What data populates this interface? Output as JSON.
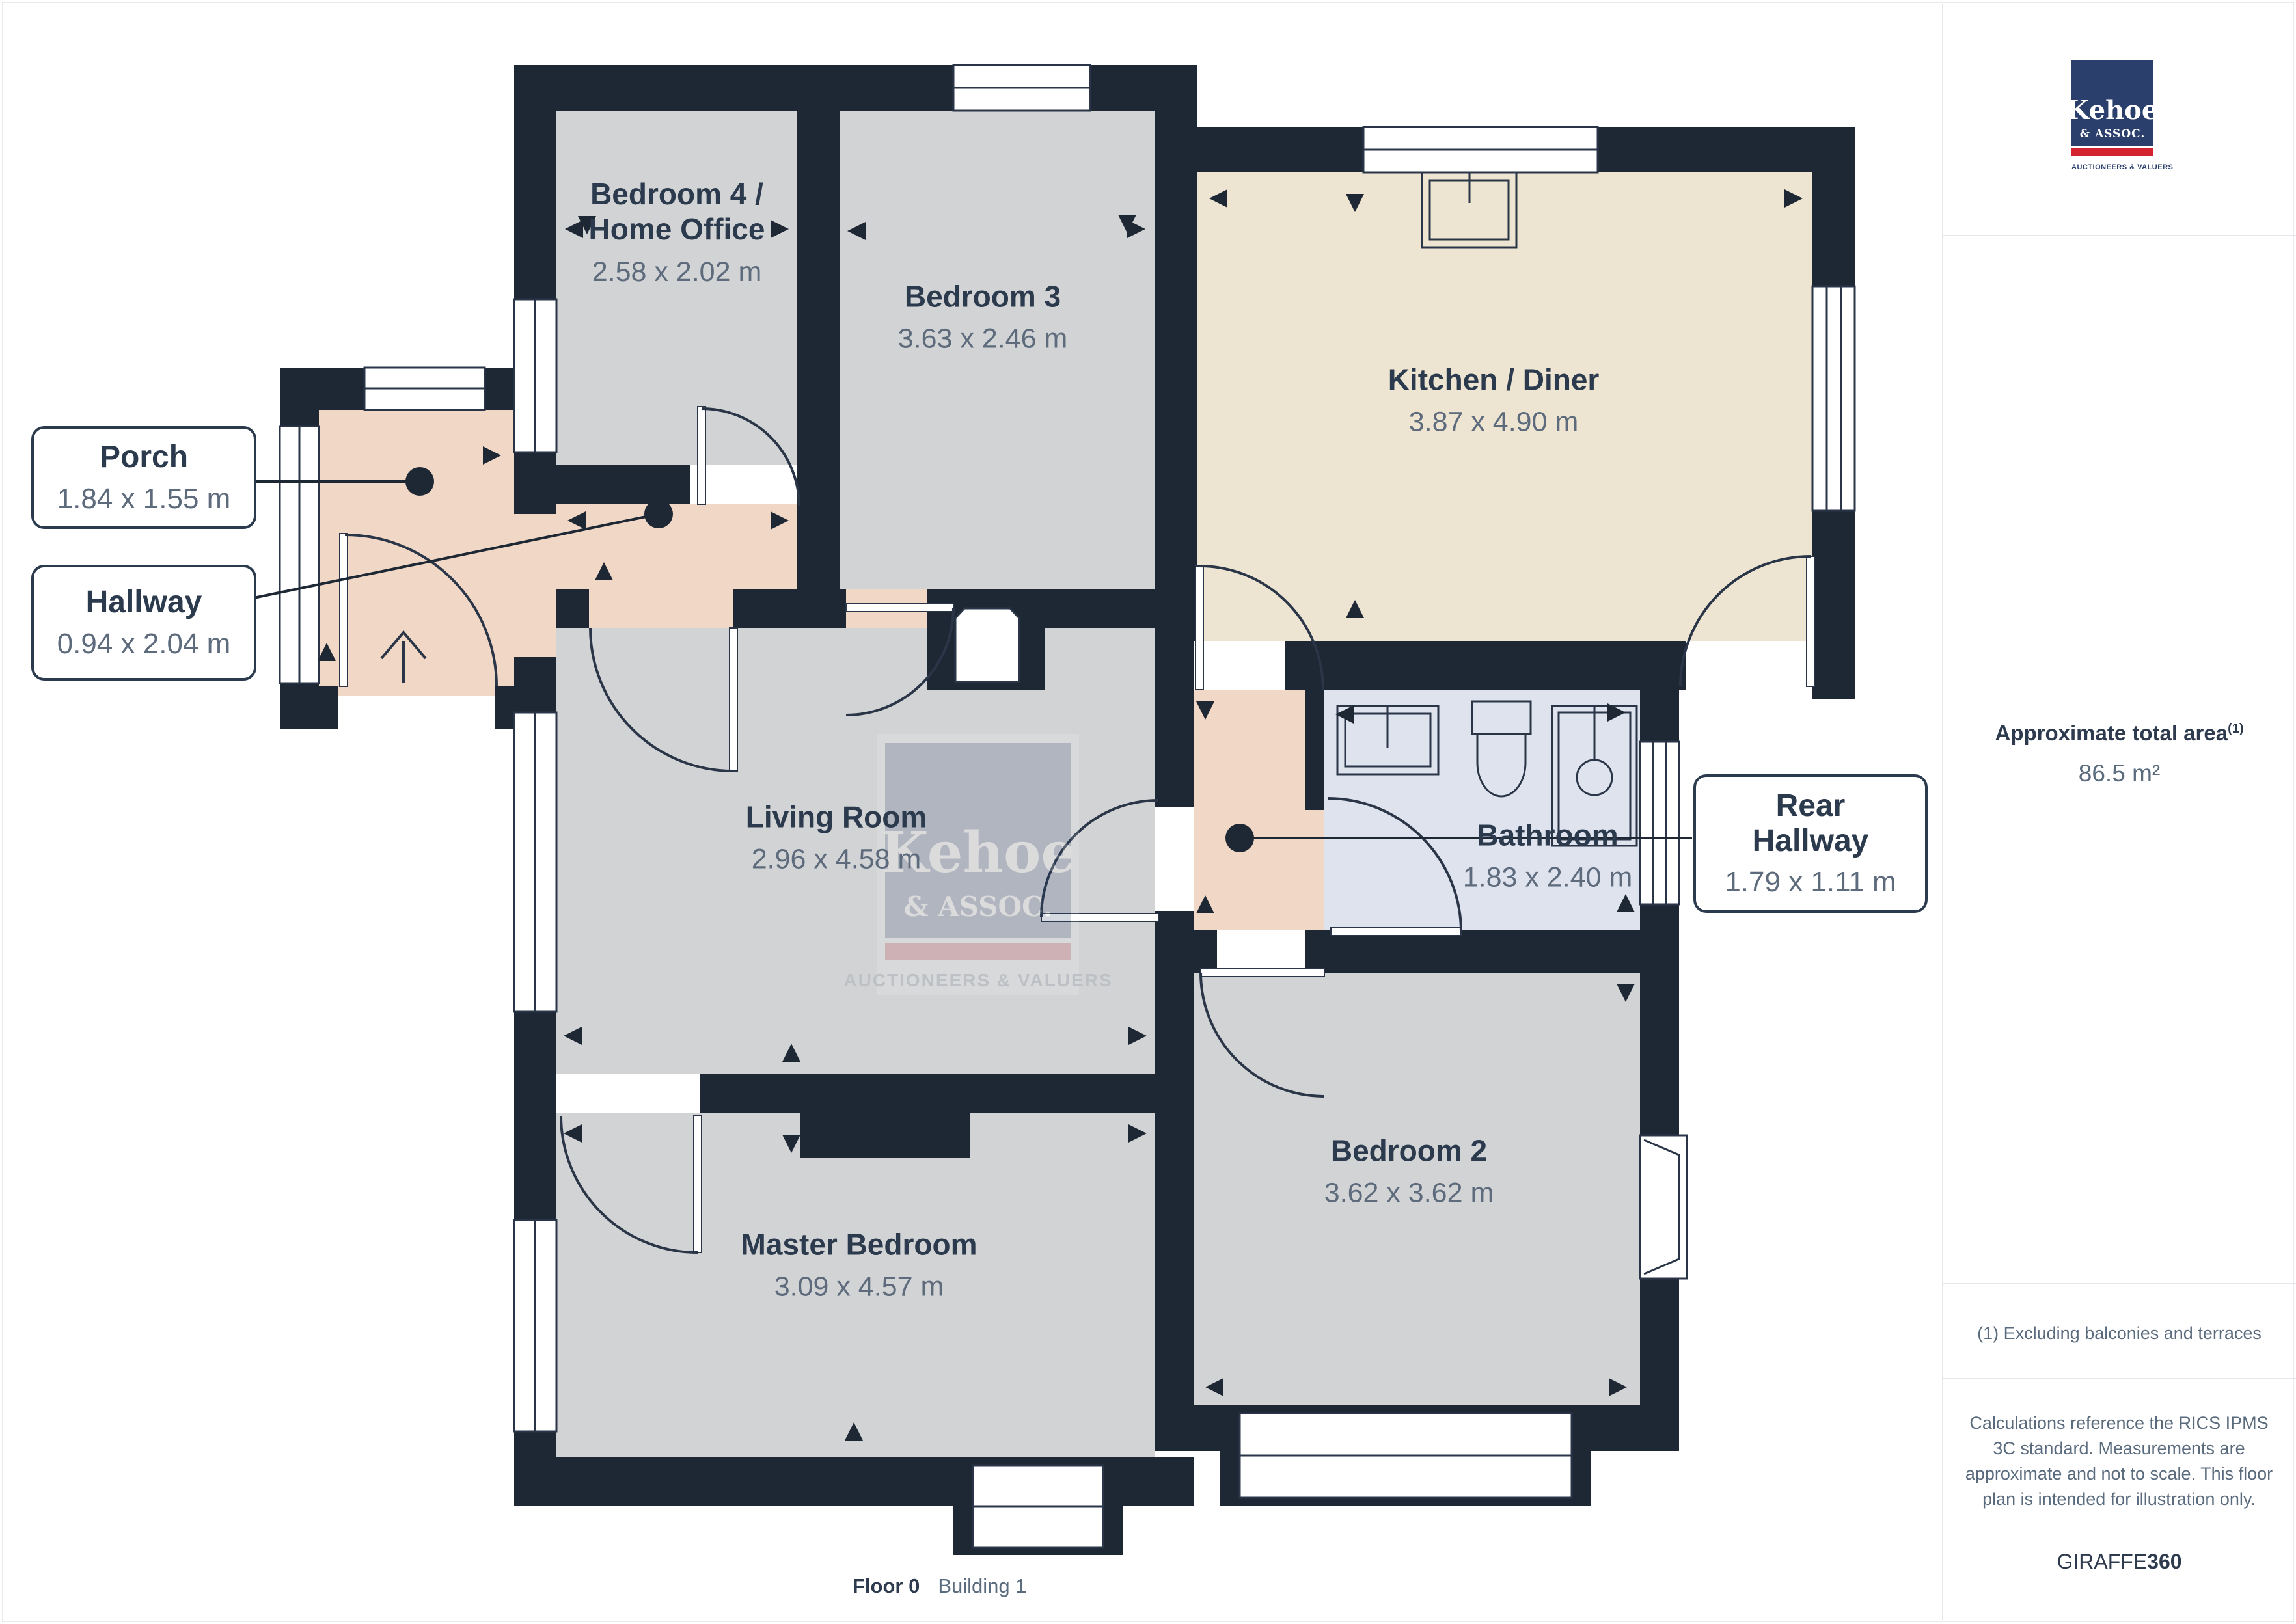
{
  "plan": {
    "rooms": {
      "bedroom4": {
        "name": "Bedroom 4 /\nHome Office",
        "dims": "2.58 x 2.02 m"
      },
      "bedroom3": {
        "name": "Bedroom 3",
        "dims": "3.63 x 2.46 m"
      },
      "kitchen": {
        "name": "Kitchen / Diner",
        "dims": "3.87 x 4.90 m"
      },
      "living": {
        "name": "Living Room",
        "dims": "2.96 x 4.58 m"
      },
      "master": {
        "name": "Master Bedroom",
        "dims": "3.09 x 4.57 m"
      },
      "bedroom2": {
        "name": "Bedroom 2",
        "dims": "3.62 x 3.62 m"
      },
      "bathroom": {
        "name": "Bathroom",
        "dims": "1.83 x 2.40 m"
      }
    },
    "callouts": {
      "porch": {
        "name": "Porch",
        "dims": "1.84 x 1.55 m"
      },
      "hallway": {
        "name": "Hallway",
        "dims": "0.94 x 2.04 m"
      },
      "rear_hallway": {
        "name": "Rear\nHallway",
        "dims": "1.79 x 1.11 m"
      }
    },
    "colors": {
      "wall": "#1e2734",
      "room_gray": "#d2d3d4",
      "kitchen_cream": "#ede5d1",
      "hall_pink": "#f1d7c6",
      "bath_blue": "#dee3ee",
      "line": "#2a3648"
    }
  },
  "watermark": {
    "line1": "Kehoe",
    "line2": "& ASSOC.",
    "tagline": "AUCTIONEERS & VALUERS"
  },
  "sidebar": {
    "logo": {
      "line1": "Kehoe",
      "line2": "& ASSOC.",
      "tagline": "AUCTIONEERS & VALUERS"
    },
    "area": {
      "label": "Approximate total area",
      "superscript": "(1)",
      "value": "86.5 m²"
    },
    "footnote": "(1) Excluding balconies and terraces",
    "disclaimer": "Calculations reference the RICS IPMS 3C standard. Measurements are approximate and not to scale. This floor plan is intended for illustration only.",
    "brand": {
      "name": "GIRAFFE",
      "suffix": "360"
    }
  },
  "footer": {
    "floor": "Floor 0",
    "building": "Building 1"
  }
}
